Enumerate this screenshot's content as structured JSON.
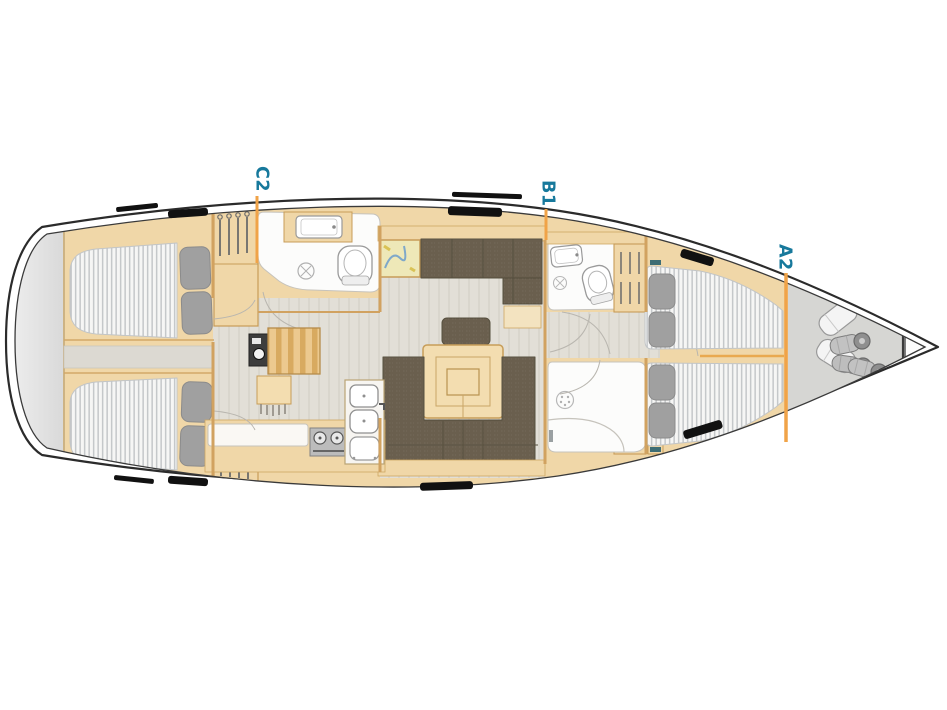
{
  "figure": {
    "type": "sailing-yacht-interior-layout-plan",
    "cabin_labels": [
      {
        "id": "c2",
        "text": "C2"
      },
      {
        "id": "b1",
        "text": "B1"
      },
      {
        "id": "a2",
        "text": "A2"
      }
    ],
    "colors": {
      "label_text": "#17799C",
      "label_leader_line": "#F0A348",
      "joinery_wood": "#F0D7A8",
      "wood_outline": "#C9A05E",
      "floor_gray": "#E1DED6",
      "upholstery_taupe": "#6F6454",
      "mattress_white": "#F6F6F5",
      "mattress_stripe": "#C5C8CA",
      "pillow_gray": "#A0A0A0",
      "hull_outline": "#2B2B2B",
      "transom_gray": "#E4E4E4",
      "bow_locker_gray": "#D6D6D3",
      "chart_map_yellow": "#F2E08A",
      "hatch_black": "#111111"
    }
  }
}
